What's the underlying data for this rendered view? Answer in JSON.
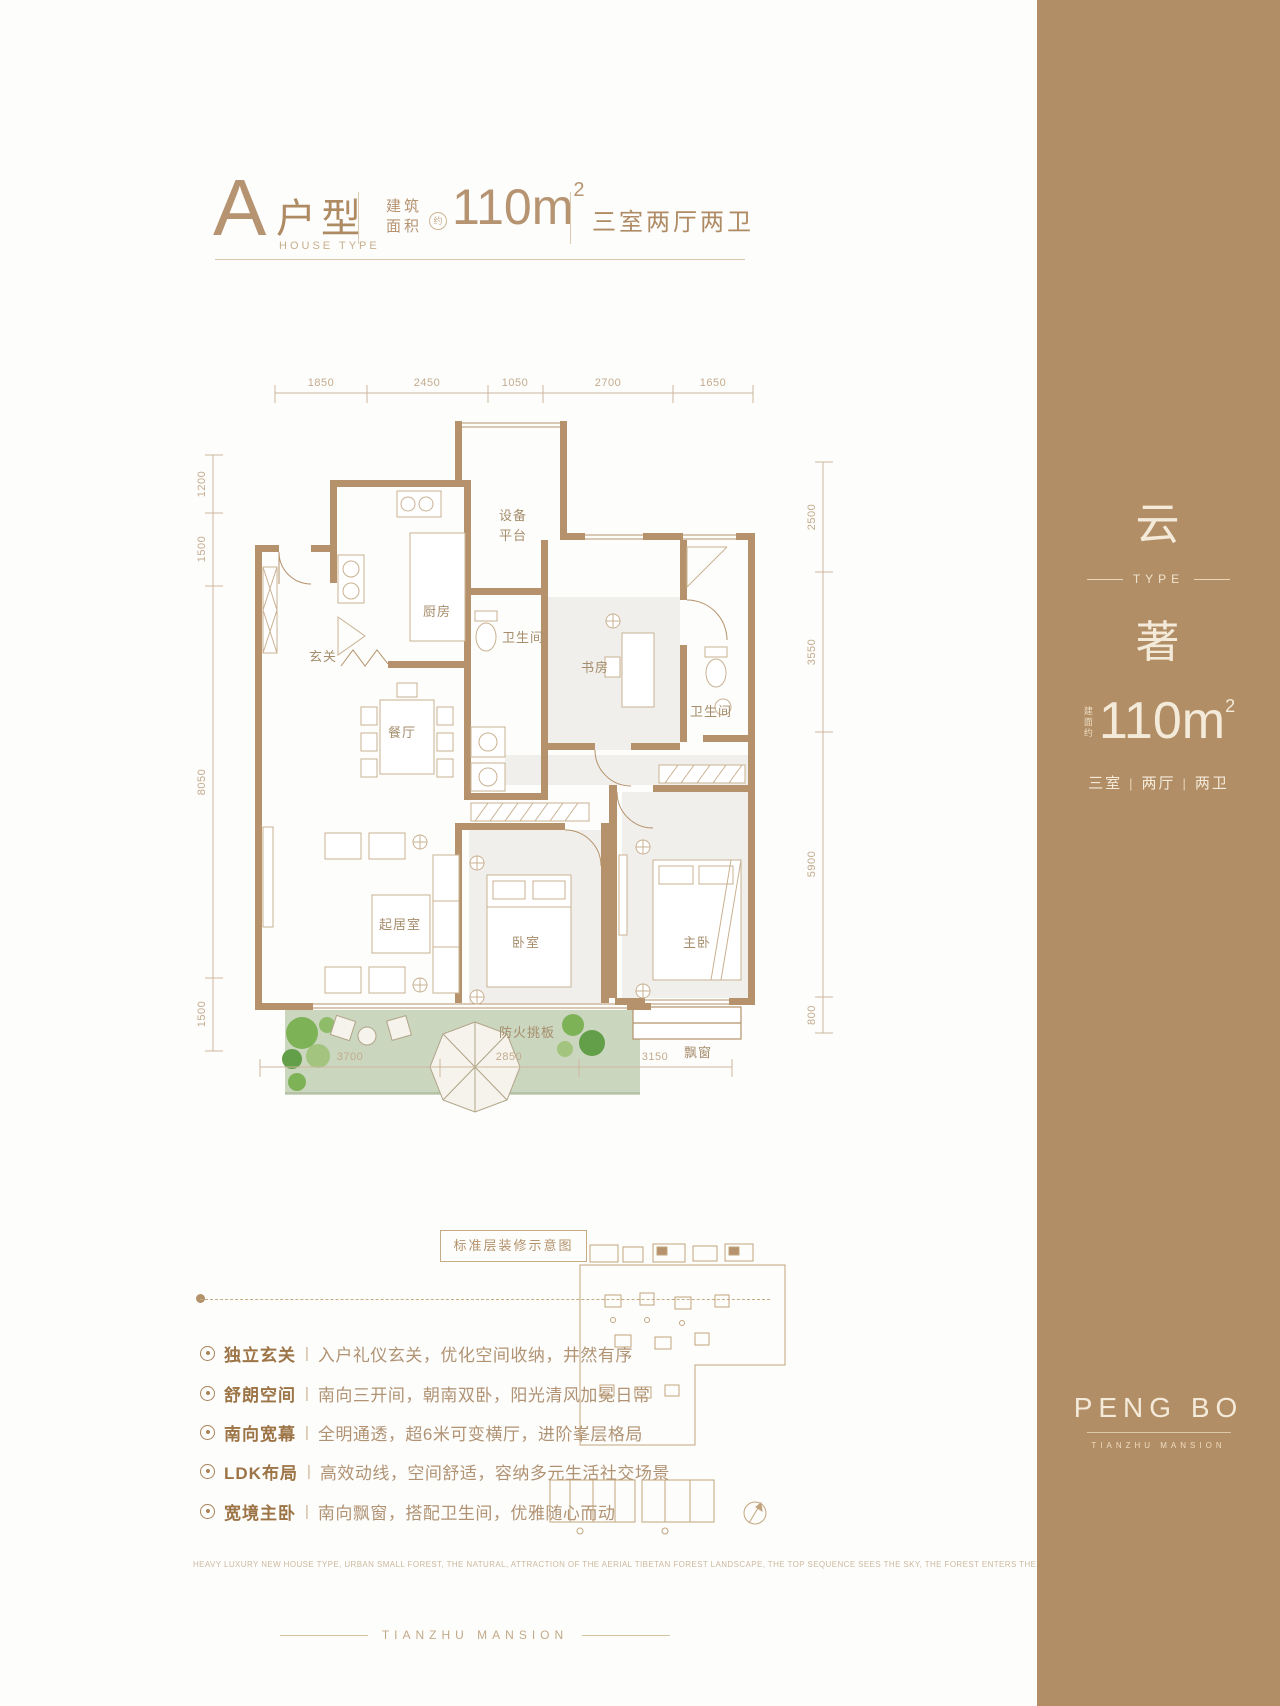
{
  "header": {
    "type_letter": "A",
    "type_name": "户型",
    "type_sub": "HOUSE TYPE",
    "area_label_1": "建筑",
    "area_label_2": "面积",
    "area_approx": "约",
    "area_value": "110m",
    "area_sup": "2",
    "rooms_summary": "三室两厅两卫"
  },
  "plan": {
    "caption": "标准层装修示意图",
    "dims_top": [
      "1850",
      "2450",
      "1050",
      "2700",
      "1650"
    ],
    "dims_left": [
      "1200",
      "1500",
      "8050",
      "1500"
    ],
    "dims_right": [
      "2500",
      "3550",
      "5900",
      "800"
    ],
    "dims_bottom": [
      "3700",
      "2850",
      "3150"
    ],
    "rooms": {
      "entry": "玄关",
      "kitchen": "厨房",
      "equipment_1": "设备",
      "equipment_2": "平台",
      "bath_1": "卫生间",
      "study": "书房",
      "bath_2": "卫生间",
      "dining": "餐厅",
      "living": "起居室",
      "bedroom": "卧室",
      "master": "主卧",
      "bay_window": "飘窗",
      "fire_board": "防火挑板"
    }
  },
  "features": [
    {
      "title": "独立玄关",
      "desc": "入户礼仪玄关，优化空间收纳，井然有序"
    },
    {
      "title": "舒朗空间",
      "desc": "南向三开间，朝南双卧，阳光清风加冕日常"
    },
    {
      "title": "南向宽幕",
      "desc": "全明通透，超6米可变横厅，进阶峯层格局"
    },
    {
      "title": "LDK布局",
      "desc": "高效动线，空间舒适，容纳多元生活社交场景"
    },
    {
      "title": "宽境主卧",
      "desc": "南向飘窗，搭配卫生间，优雅随心而动"
    }
  ],
  "features_sep": "|",
  "footer": {
    "english_line": "HEAVY LUXURY NEW HOUSE TYPE, URBAN SMALL FOREST, THE NATURAL, ATTRACTION OF THE AERIAL TIBETAN FOREST LANDSCAPE, THE TOP SEQUENCE SEES THE SKY, THE FOREST ENTERS THE CLOUDS",
    "brand": "TIANZHU MANSION"
  },
  "sidebar": {
    "type_char_top": "云",
    "type_label": "TYPE",
    "type_char_bottom": "著",
    "area_prefix": "建面约",
    "area_value": "110m",
    "area_sup": "2",
    "layout": [
      "三室",
      "两厅",
      "两卫"
    ],
    "layout_sep": "|",
    "brand": "PENG BO",
    "brand_sub": "TIANZHU MANSION"
  },
  "colors": {
    "accent_brown": "#b5926b",
    "sidebar_bg": "#b28e66",
    "sidebar_text": "#f4ead9",
    "room_fill": "#f0efec",
    "balcony_green": "#cbd6bf",
    "dim_text": "#c3ab8d"
  }
}
